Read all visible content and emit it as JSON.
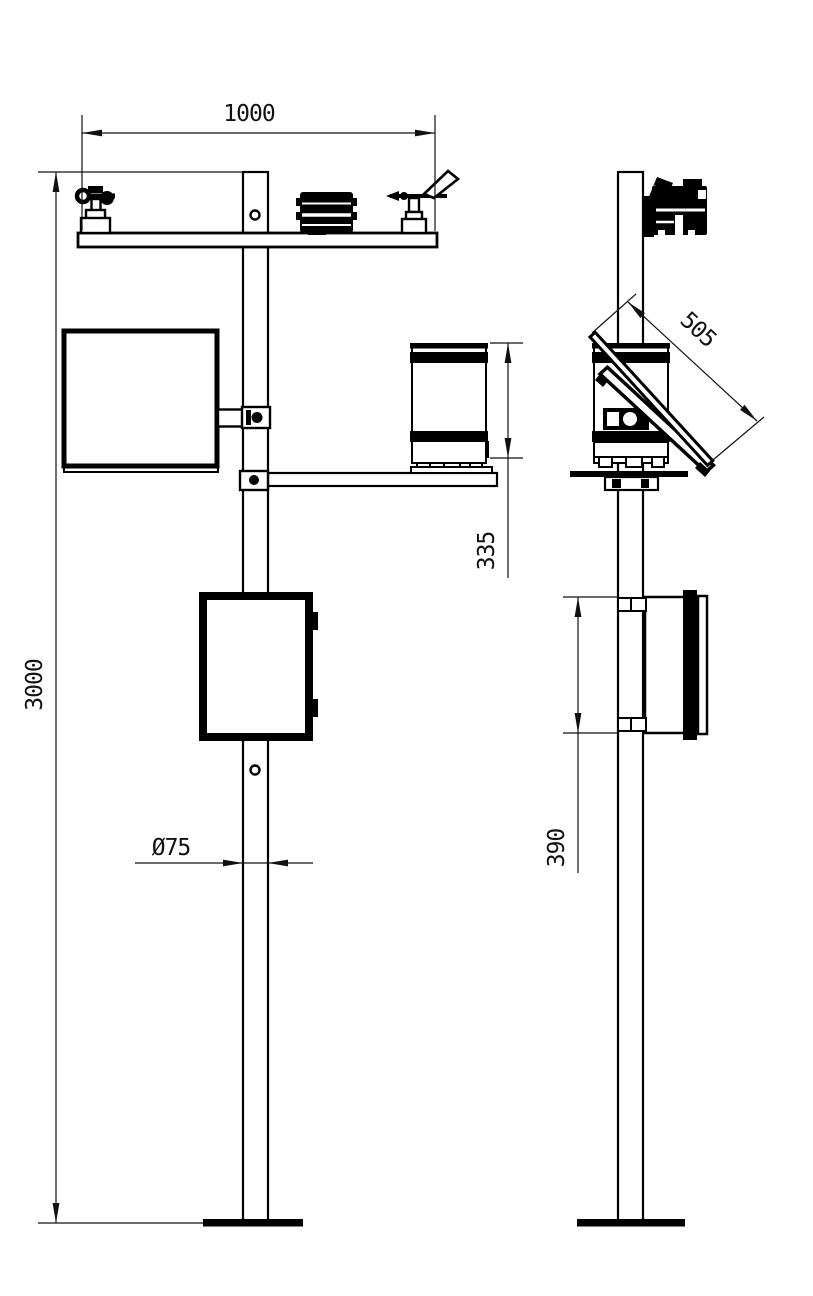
{
  "drawing": {
    "type": "technical-installation-drawing",
    "views": {
      "front": "front view",
      "side": "side view"
    },
    "dimensions": {
      "crossarm_width": "1000",
      "pole_height": "3000",
      "rain_gauge_height": "335",
      "pole_diameter": "Ø75",
      "solar_panel_length": "505",
      "control_box_height": "390"
    },
    "colors": {
      "line": "#000000",
      "background": "#ffffff"
    }
  }
}
